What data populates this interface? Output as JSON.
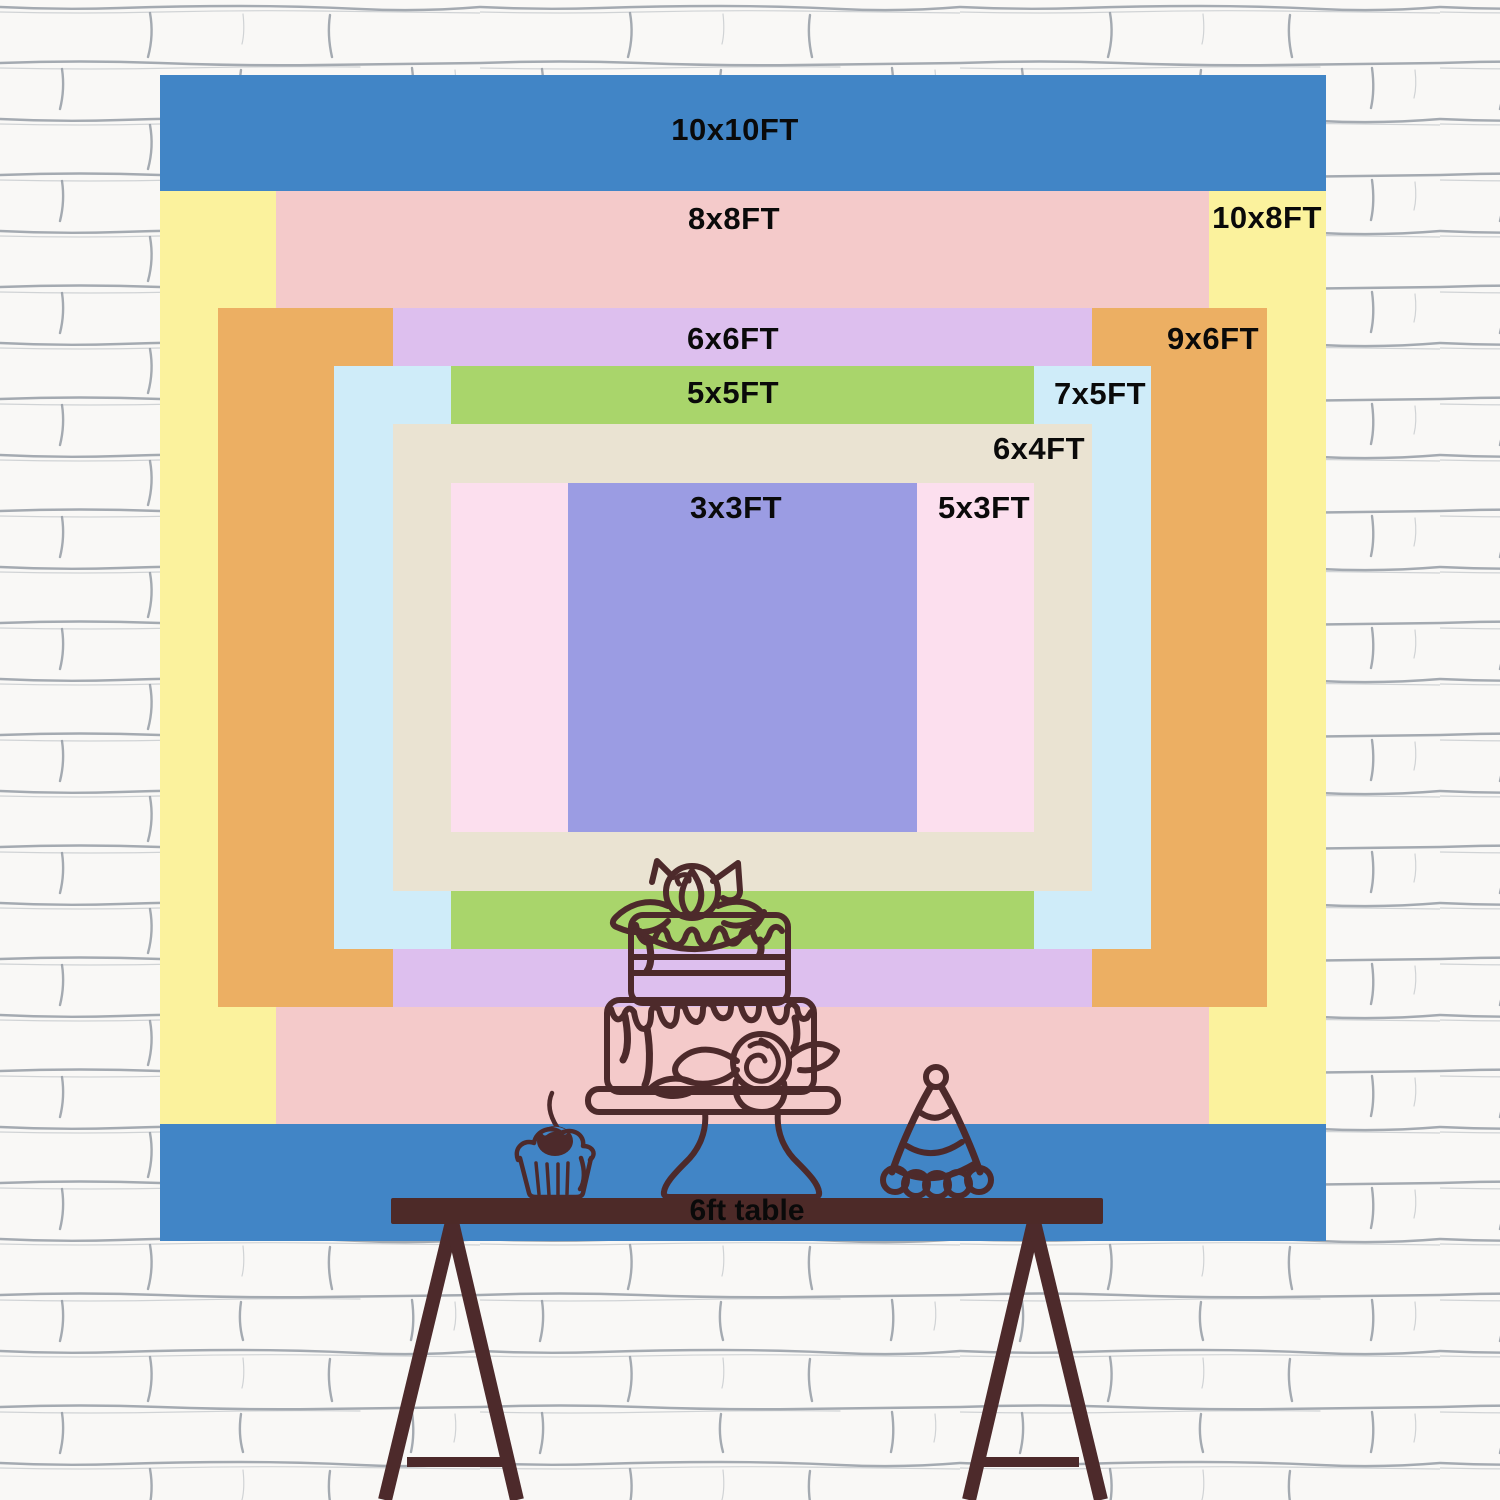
{
  "background": {
    "wall_color": "#f8f7f5",
    "mortar_color": "#8f96a0",
    "description": "white sketched brick wall"
  },
  "backdrop": {
    "center_x": 742.5,
    "center_y": 657.5,
    "px_per_ft": 116.6,
    "label_color": "#0a0a0a",
    "sizes": [
      {
        "label": "10x10FT",
        "w": 10,
        "h": 10,
        "color": "#4185c6",
        "label_x": 735,
        "label_y": 130
      },
      {
        "label": "10x8FT",
        "w": 10,
        "h": 8,
        "color": "#fbf29d",
        "label_x": 1267,
        "label_y": 218
      },
      {
        "label": "8x8FT",
        "w": 8,
        "h": 8,
        "color": "#f4caca",
        "label_x": 734,
        "label_y": 219
      },
      {
        "label": "9x6FT",
        "w": 9,
        "h": 6,
        "color": "#ecaf63",
        "label_x": 1213,
        "label_y": 339
      },
      {
        "label": "6x6FT",
        "w": 6,
        "h": 6,
        "color": "#ddbfee",
        "label_x": 733,
        "label_y": 339
      },
      {
        "label": "7x5FT",
        "w": 7,
        "h": 5,
        "color": "#cfecf9",
        "label_x": 1100,
        "label_y": 394
      },
      {
        "label": "5x5FT",
        "w": 5,
        "h": 5,
        "color": "#a9d56b",
        "label_x": 733,
        "label_y": 393
      },
      {
        "label": "6x4FT",
        "w": 6,
        "h": 4,
        "color": "#eae3d2",
        "label_x": 1039,
        "label_y": 449
      },
      {
        "label": "5x3FT",
        "w": 5,
        "h": 3,
        "color": "#fcdfee",
        "label_x": 984,
        "label_y": 508
      },
      {
        "label": "3x3FT",
        "w": 3,
        "h": 3,
        "color": "#9b9ce3",
        "label_x": 736,
        "label_y": 508
      }
    ]
  },
  "table": {
    "label": "6ft table",
    "color": "#4d2a28"
  },
  "artwork": {
    "line_color": "#4d2a2b",
    "cherry_highlight": "#4185c6",
    "items": [
      "two-tier-cake-on-stand",
      "cupcake-with-cherry",
      "party-hat",
      "trestle-table"
    ]
  }
}
